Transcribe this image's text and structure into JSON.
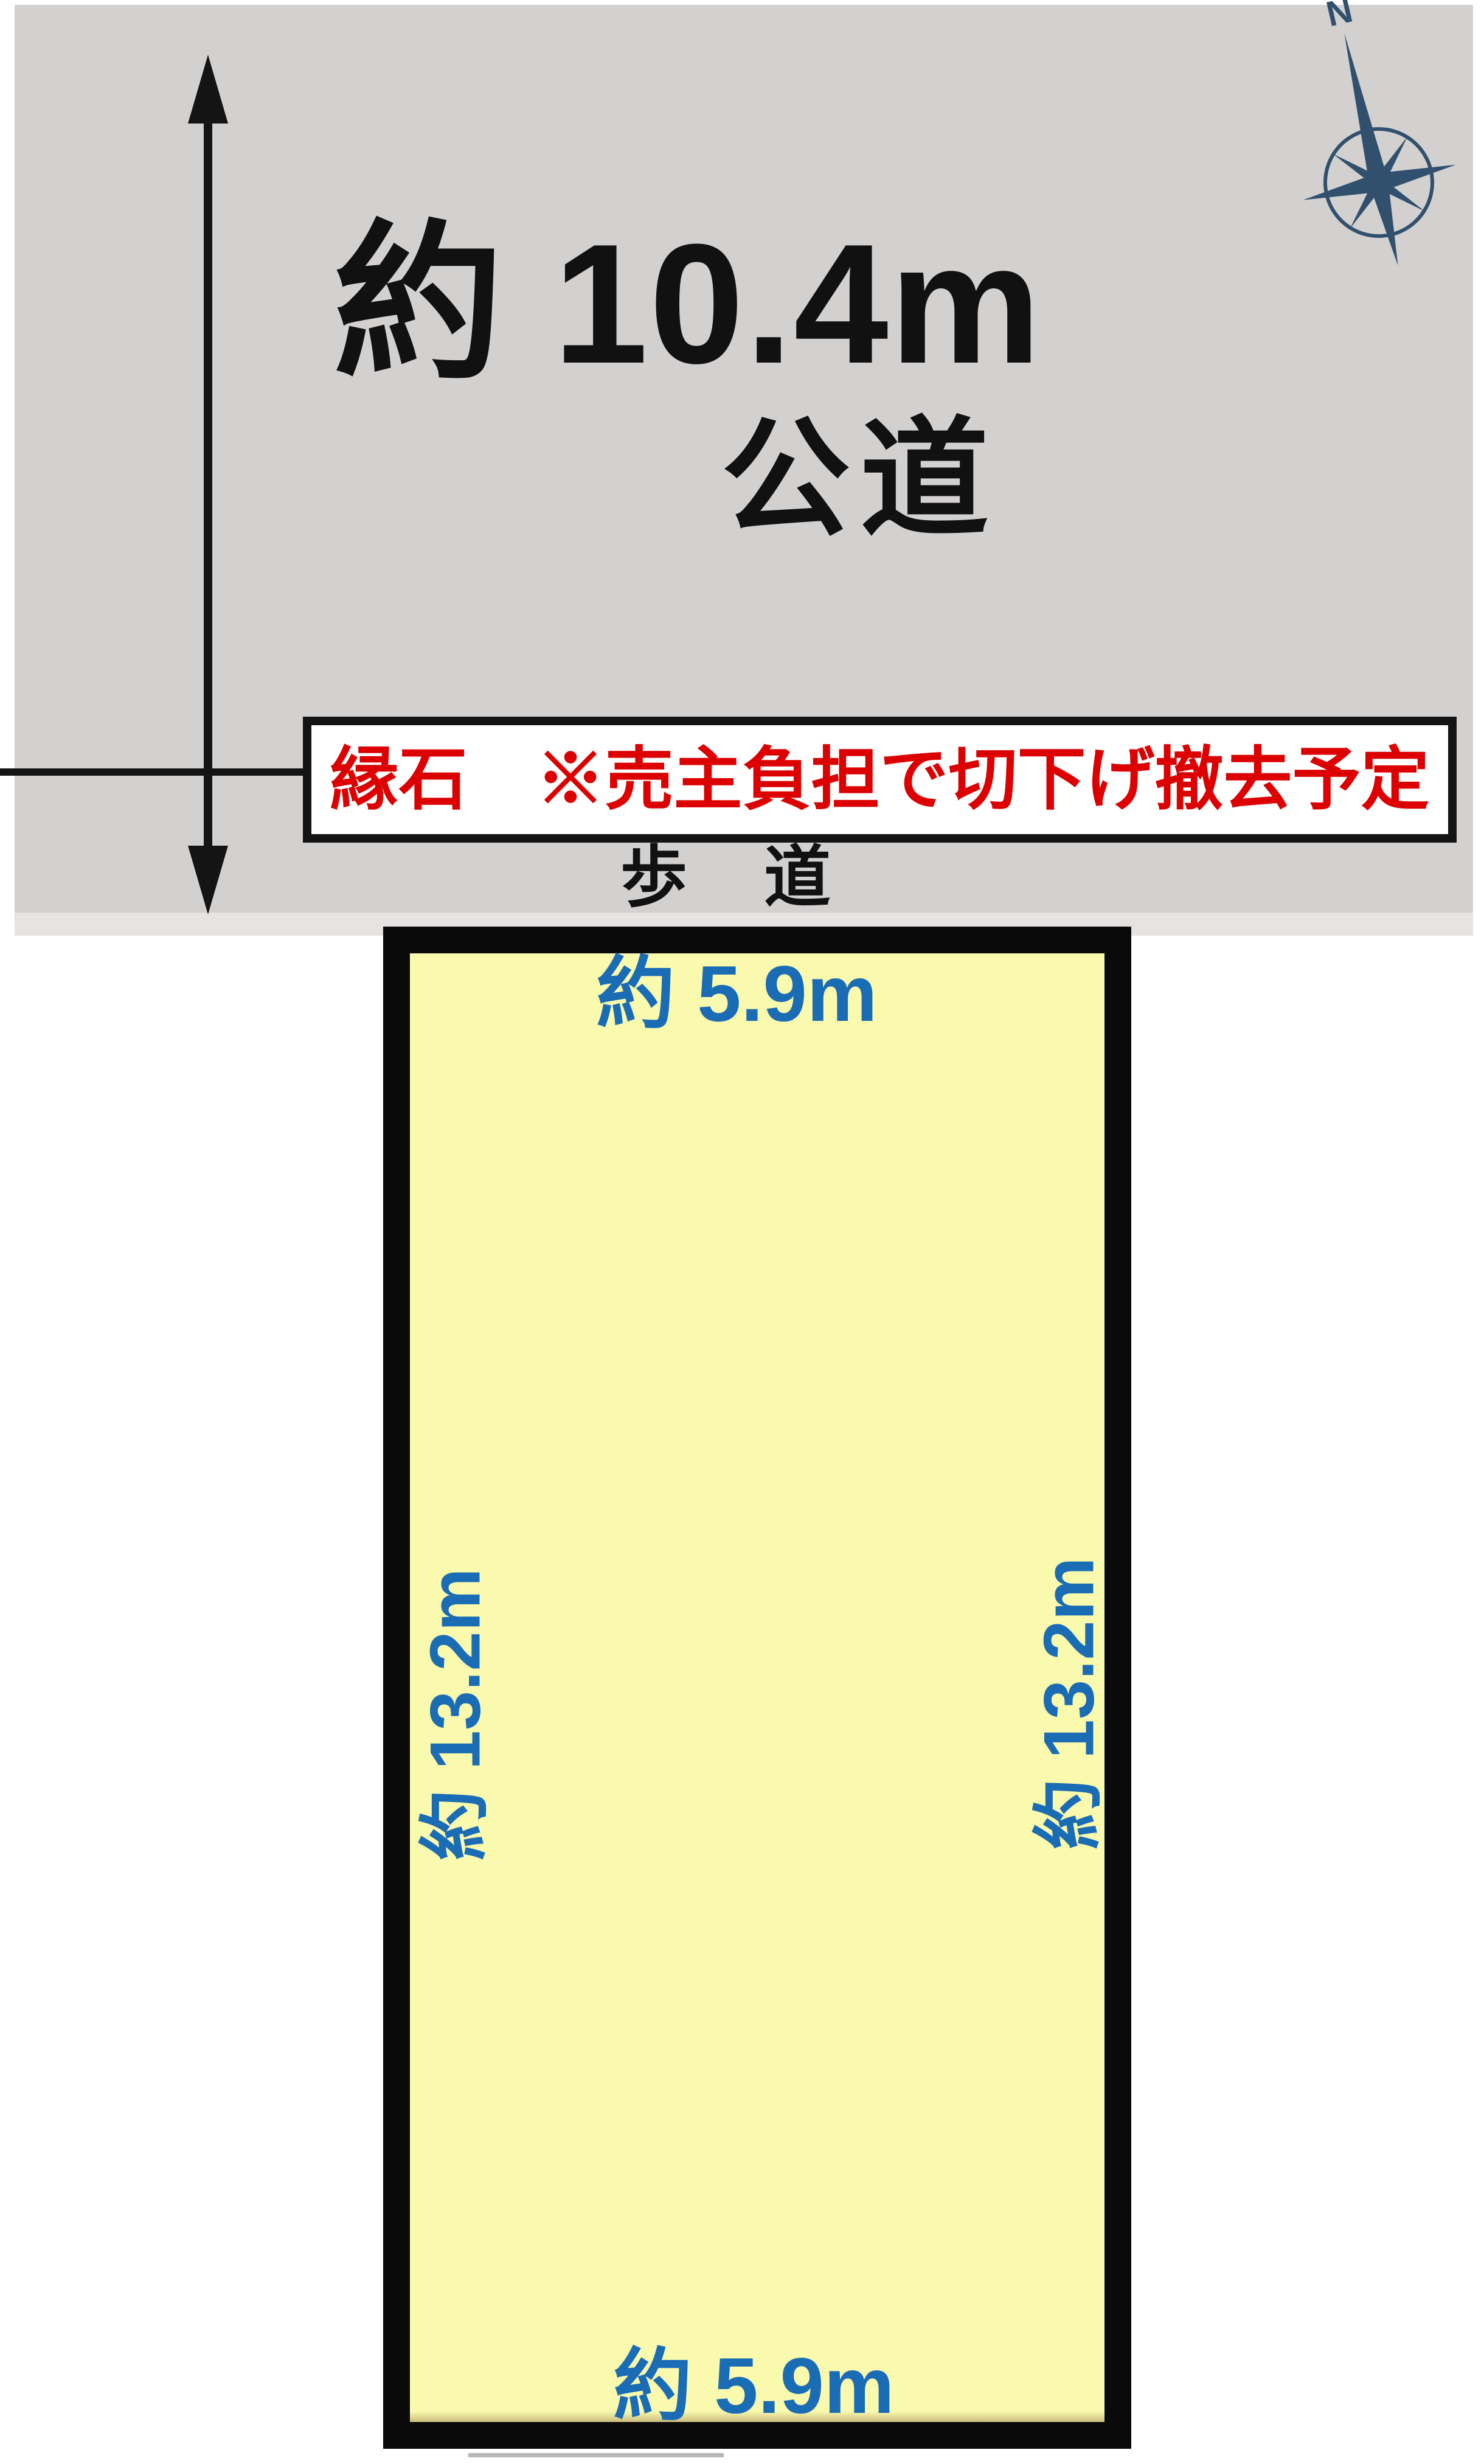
{
  "diagram": {
    "road": {
      "width_label": "約 10.4m",
      "type_label": "公道"
    },
    "curb_note": "縁石　※売主負担で切下げ撤去予定",
    "sidewalk_label": "歩　道",
    "compass": {
      "north_label": "N"
    },
    "plot_dimensions": {
      "top": "約 5.9m",
      "bottom": "約 5.9m",
      "left": "約 13.2m",
      "right": "約 13.2m"
    },
    "colors": {
      "road_gray": "#d3d0d0",
      "road_light_band": "#e6e3e3",
      "plot_fill": "#fafaae",
      "plot_border": "#0a0a0a",
      "dimension_blue": "#1a6cb5",
      "note_red": "#dc0000",
      "compass_navy": "#31506e"
    }
  }
}
